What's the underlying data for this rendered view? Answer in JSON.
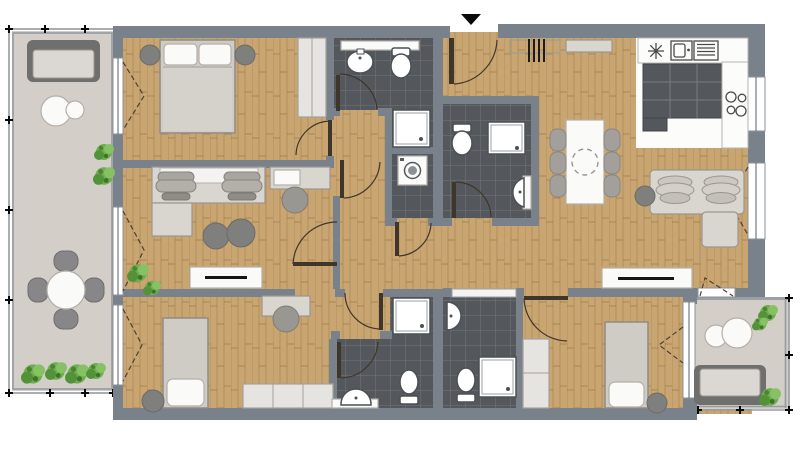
{
  "palette": {
    "wall": "#79818a",
    "wood": "#c9a671",
    "tile": "#54585c",
    "balcony": "#d3cec8",
    "kitchen_floor": "#fcfcfb",
    "furniture_light": "#d9d6d0",
    "furniture_outline": "#9b978f",
    "furniture_white": "#fafaf8",
    "furniture_dark": "#7f7f7d",
    "bed": "#cfccc5",
    "wardrobe": "#e6e4e0",
    "door": "#3f362b",
    "window": "#ffffff",
    "window_frame": "#8b939a",
    "plant": "#6fae52",
    "entrance_marker": "#0a0a0a"
  },
  "plan": {
    "entrance": {
      "marker": "arrow-down"
    },
    "rooms": [
      {
        "name": "bedroom-top-left",
        "floor": "wood",
        "items": [
          "double-bed",
          "pillow",
          "pillow",
          "nightstand",
          "nightstand",
          "wardrobe",
          "french-window"
        ]
      },
      {
        "name": "office-room",
        "floor": "wood",
        "items": [
          "double-desk",
          "office-chair",
          "office-chair",
          "desk-return",
          "side-desk",
          "desk-chair",
          "pouf",
          "pouf",
          "tv-lowboard",
          "plant",
          "french-window"
        ]
      },
      {
        "name": "bedroom-bottom-left",
        "floor": "wood",
        "items": [
          "single-bed",
          "stool",
          "desk",
          "desk-chair",
          "wardrobe",
          "french-window"
        ]
      },
      {
        "name": "bathroom-top",
        "floor": "dark-tile",
        "items": [
          "shelf",
          "washbasin",
          "toilet",
          "shower",
          "washing-machine"
        ]
      },
      {
        "name": "bathroom-bottom-left",
        "floor": "dark-tile",
        "items": [
          "shower",
          "toilet",
          "washbasin",
          "vanity-counter"
        ]
      },
      {
        "name": "entrance-hall",
        "floor": "wood",
        "items": [
          "entrance-door",
          "coat-rack",
          "shoe-shelf"
        ]
      },
      {
        "name": "bathroom-entrance",
        "floor": "dark-tile",
        "items": [
          "toilet",
          "shower",
          "washbasin"
        ]
      },
      {
        "name": "living-dining-kitchen",
        "floor": "wood",
        "items": [
          "kitchen-counter",
          "kitchen-sink",
          "fridge",
          "kitchen-cabinets",
          "cooktop",
          "dining-table",
          "dining-chair-x6",
          "corner-sofa",
          "side-table",
          "tv-lowboard"
        ]
      },
      {
        "name": "bathroom-bottom-right",
        "floor": "dark-tile",
        "items": [
          "washbasin",
          "toilet",
          "shower",
          "sliding-door"
        ]
      },
      {
        "name": "bedroom-bottom-right",
        "floor": "wood",
        "items": [
          "single-bed",
          "stool",
          "wardrobe",
          "balcony-door"
        ]
      },
      {
        "name": "balcony-left",
        "floor": "balcony",
        "items": [
          "garden-bench",
          "side-table",
          "side-table",
          "round-table",
          "garden-chair-x4",
          "plant-x8"
        ]
      },
      {
        "name": "balcony-bottom-right",
        "floor": "balcony",
        "items": [
          "garden-bench",
          "side-table",
          "side-table",
          "plant-x3"
        ]
      }
    ]
  }
}
